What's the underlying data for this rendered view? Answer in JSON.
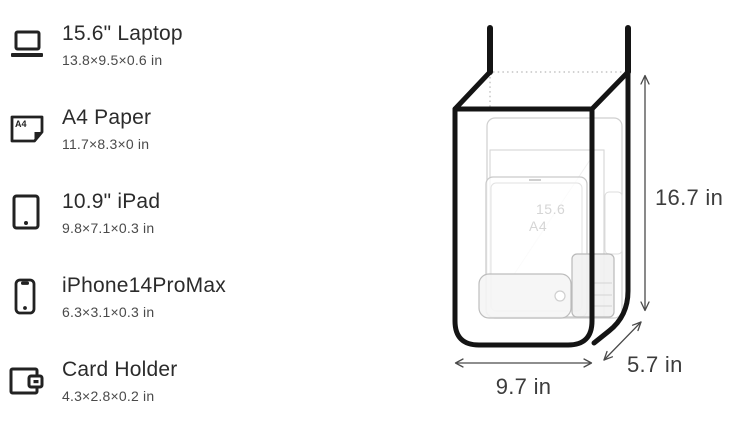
{
  "items": [
    {
      "label": "15.6\" Laptop",
      "dimensions": "13.8×9.5×0.6 in",
      "icon": "laptop-icon"
    },
    {
      "label": "A4 Paper",
      "dimensions": "11.7×8.3×0 in",
      "icon": "a4-paper-icon"
    },
    {
      "label": "10.9\" iPad",
      "dimensions": "9.8×7.1×0.3 in",
      "icon": "tablet-icon"
    },
    {
      "label": "iPhone14ProMax",
      "dimensions": "6.3×3.1×0.3 in",
      "icon": "phone-icon"
    },
    {
      "label": "Card Holder",
      "dimensions": "4.3×2.8×0.2 in",
      "icon": "card-holder-icon"
    }
  ],
  "diagram": {
    "height_label": "16.7 in",
    "width_label": "9.7 in",
    "depth_label": "5.7 in",
    "inner_labels": {
      "laptop": "15.6",
      "paper": "A4"
    },
    "colors": {
      "outline": "#141414",
      "title_text": "#2b2b2b",
      "subtitle_text": "#4a4a4a",
      "dimension_text": "#3c3c3c",
      "faint_item_outline": "#cccccc"
    }
  }
}
